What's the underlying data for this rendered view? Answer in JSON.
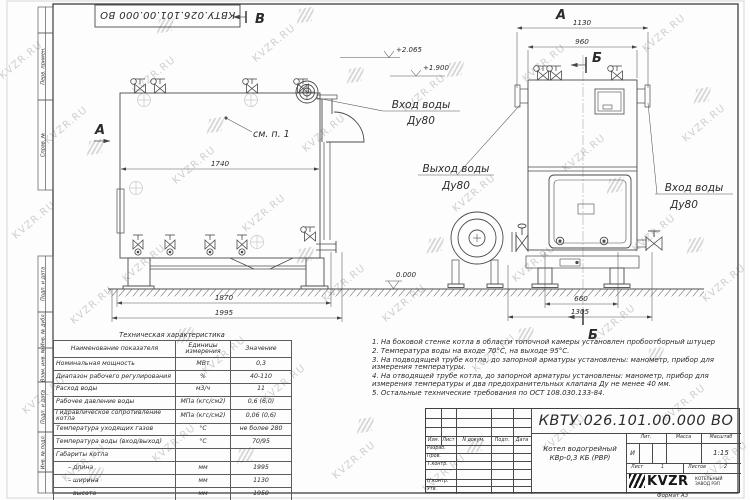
{
  "watermark": {
    "text": "KVZR.RU"
  },
  "stamp_top": "КВТУ.026.101.00.000  ВО",
  "frame_cells": [
    "Перв. примен.",
    "Справ. №",
    "Подп. и дата",
    "Инв. № дубл.",
    "Взам. инв. №",
    "Подп. и дата",
    "Инв. № подл."
  ],
  "drawing": {
    "marker_view_b": "В",
    "marker_section_a": "А",
    "marker_view_a": "А",
    "marker_section_b_top": "Б",
    "marker_section_b_bottom": "Б",
    "see_note": "см. п. 1",
    "inlet_left_1": "Вход воды",
    "inlet_left_2": "Ду80",
    "outlet_1": "Выход воды",
    "outlet_2": "Ду80",
    "inlet_right_1": "Вход воды",
    "inlet_right_2": "Ду80",
    "dim_body_length": "1740",
    "dim_base_length": "1870",
    "dim_total_length": "1995",
    "dim_total_width": "1130",
    "dim_body_width": "960",
    "dim_base_width": "660",
    "dim_overall_width": "1305",
    "level_top": "+2.065",
    "level_body": "+1.900",
    "level_zero": "0.000"
  },
  "spec_table": {
    "title": "Техническая характеристика",
    "headers": [
      "Наименование показателя",
      "Единицы измерения",
      "Значение"
    ],
    "rows": [
      [
        "Номинальная мощность",
        "МВт",
        "0,3"
      ],
      [
        "Диапазон рабочего регулирования",
        "%",
        "40-110"
      ],
      [
        "Расход воды",
        "м3/ч",
        "11"
      ],
      [
        "Рабочее давление воды",
        "МПа (кгс/см2)",
        "0,6 (6,0)"
      ],
      [
        "Гидравлическое сопротивление котла",
        "МПа (кгс/см2)",
        "0,06 (0,6)"
      ],
      [
        "Температура уходящих газов",
        "°С",
        "не более 280"
      ],
      [
        "Температура воды (вход/выход)",
        "°С",
        "70/95"
      ],
      [
        "Габариты котла",
        "",
        ""
      ],
      [
        "– длина",
        "мм",
        "1995"
      ],
      [
        "– ширина",
        "мм",
        "1130"
      ],
      [
        "– высота",
        "мм",
        "1950"
      ]
    ]
  },
  "notes": [
    "1. На боковой стенке котла в области топочной камеры установлен пробоотборный штуцер",
    "2. Температура воды на входе 70°С, на выходе 95°С.",
    "3. На подводящей трубе котла, до запорной арматуры установлены: манометр, прибор для измерения температуры.",
    "4. На отводящей трубе котла, до запорной арматуры установлены: манометр, прибор для измерения температуры и два предохранительных клапана Ду не менее 40 мм.",
    "5. Остальные технические требования по ОСТ 108.030.133-84."
  ],
  "title_block": {
    "doc_number": "КВТУ.026.101.00.000  ВО",
    "product_line1": "Котел водогрейный",
    "product_line2": "КВр-0,3 КБ (РВР)",
    "col_izm": "Изм.",
    "col_list": "Лист",
    "col_doc": "N докум.",
    "col_sign": "Подп.",
    "col_date": "Дата",
    "row_developed": "Разраб.",
    "row_checked": "Пров.",
    "row_tcontrol": "Т.контр.",
    "row_ncontrol": "Н.контр.",
    "row_approved": "Утв.",
    "lit_label": "Лит.",
    "mass_label": "Масса",
    "scale_label": "Масштаб",
    "lit_value": "И",
    "scale_value": "1:15",
    "sheet_label": "Лист",
    "sheet_value": "1",
    "sheets_label": "Листов",
    "sheets_value": "2",
    "brand": "KVZR",
    "brand_sub1": "КОТЕЛЬНЫЙ",
    "brand_sub2": "ЗАВОД РЭП",
    "format_note": "Формат  А3"
  }
}
